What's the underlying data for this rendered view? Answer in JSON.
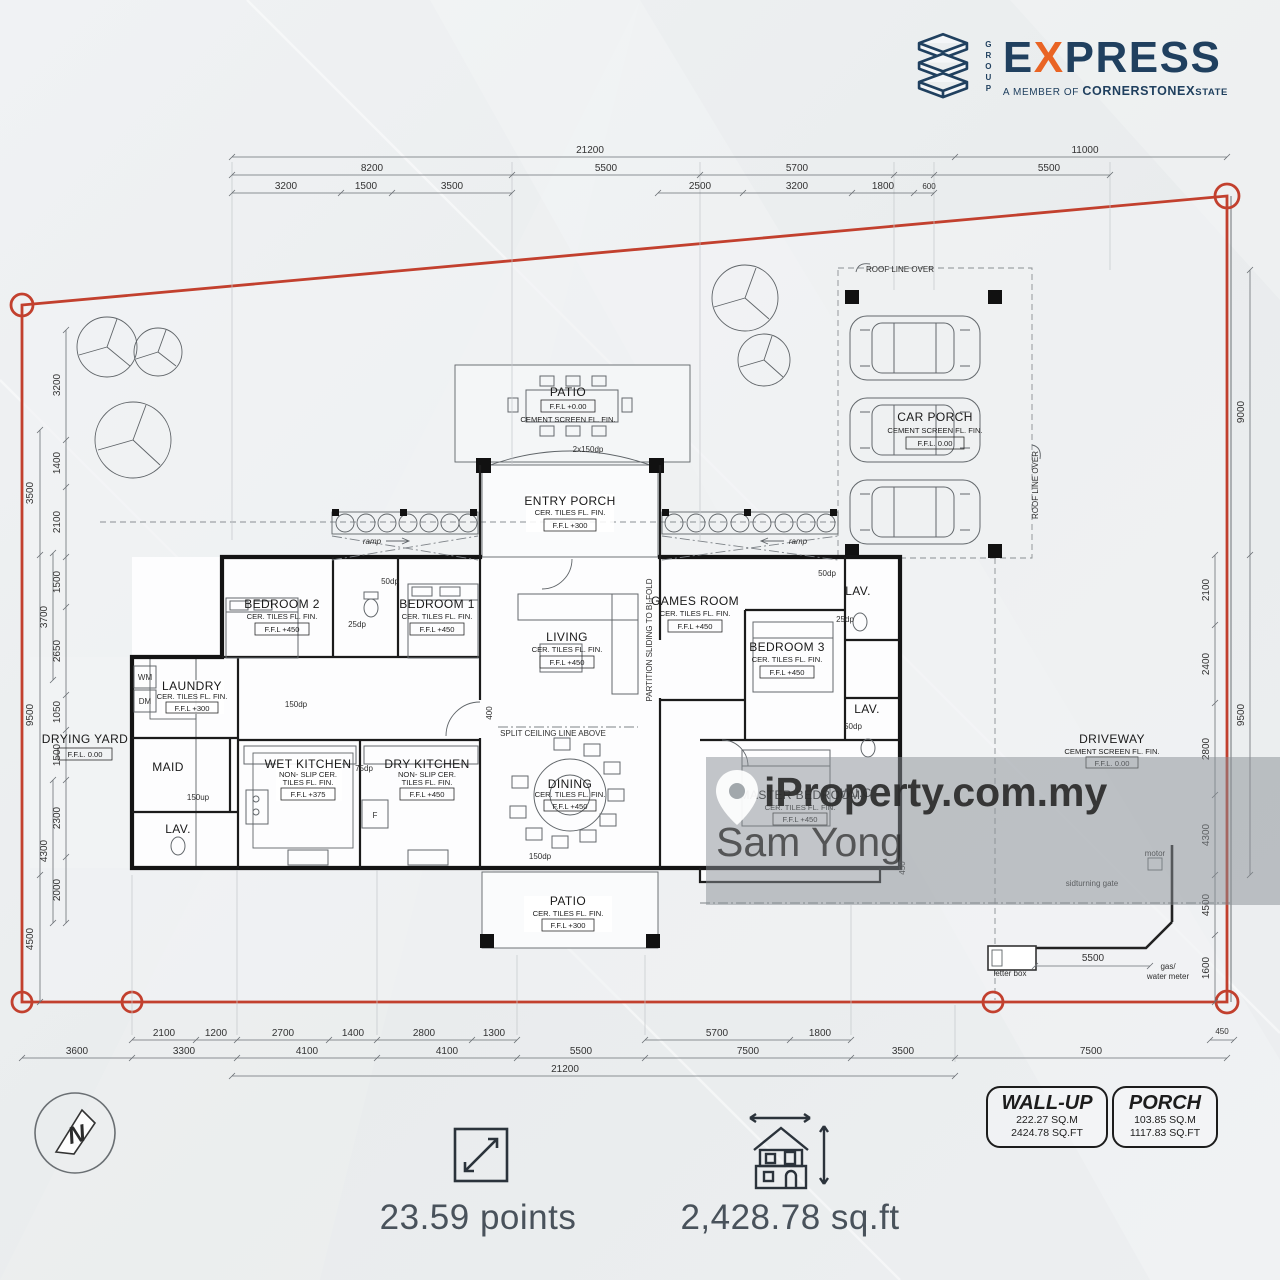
{
  "logo": {
    "group": "GROUP",
    "e": "E",
    "x": "X",
    "press": "PRESS",
    "member": "A MEMBER OF",
    "cornerstone": "CORNERSTONE",
    "x2": "X",
    "state": "STATE",
    "navy": "#20405f",
    "orange": "#e96424"
  },
  "watermark": {
    "brand": "iProperty.com.my",
    "agent": "Sam Yong"
  },
  "compass": {
    "n": "N"
  },
  "footer": {
    "points": "23.59 points",
    "area": "2,428.78 sq.ft"
  },
  "boxes": {
    "wall_up": {
      "title": "WALL-UP",
      "sqm": "222.27  SQ.M",
      "sqft": "2424.78  SQ.FT"
    },
    "porch": {
      "title": "PORCH",
      "sqm": "103.85  SQ.M",
      "sqft": "1117.83  SQ.FT"
    }
  },
  "rooms": {
    "patio_top": {
      "name": "PATIO",
      "ffl": "F.F.L +0.00",
      "l1": "CEMENT SCREEN FL. FIN."
    },
    "entry_porch": {
      "name": "ENTRY PORCH",
      "l1": "CER. TILES FL. FIN.",
      "ffl": "F.F.L +300"
    },
    "car_porch": {
      "name": "CAR PORCH",
      "l1": "CEMENT SCREEN FL. FIN.",
      "ffl": "F.F.L. 0.00"
    },
    "bedroom2": {
      "name": "BEDROOM 2",
      "l1": "CER. TILES FL. FIN.",
      "ffl": "F.F.L +450"
    },
    "bedroom1": {
      "name": "BEDROOM 1",
      "l1": "CER. TILES FL. FIN.",
      "ffl": "F.F.L +450"
    },
    "living": {
      "name": "LIVING",
      "l1": "CER. TILES FL. FIN.",
      "ffl": "F.F.L +450"
    },
    "games": {
      "name": "GAMES ROOM",
      "l1": "CER. TILES FL. FIN.",
      "ffl": "F.F.L +450"
    },
    "bedroom3": {
      "name": "BEDROOM 3",
      "l1": "CER. TILES FL. FIN.",
      "ffl": "F.F.L +450"
    },
    "laundry": {
      "name": "LAUNDRY",
      "l1": "CER. TILES FL. FIN.",
      "ffl": "F.F.L +300"
    },
    "drying": {
      "name": "DRYING YARD",
      "ffl": "F.F.L. 0.00"
    },
    "maid": {
      "name": "MAID"
    },
    "lav": {
      "name": "LAV."
    },
    "wet_kitchen": {
      "name": "WET KITCHEN",
      "l1": "NON- SLIP CER.",
      "l2": "TILES FL. FIN.",
      "ffl": "F.F.L +375"
    },
    "dry_kitchen": {
      "name": "DRY KITCHEN",
      "l1": "NON- SLIP CER.",
      "l2": "TILES FL. FIN.",
      "ffl": "F.F.L +450"
    },
    "dining": {
      "name": "DINING",
      "l1": "CER. TILES FL. FIN.",
      "ffl": "F.F.L +450"
    },
    "master": {
      "name": "MASTER BEDROOM",
      "l1": "CER. TILES FL. FIN.",
      "ffl": "F.F.L +450"
    },
    "wic": {
      "name": "W.I.C"
    },
    "patio_bottom": {
      "name": "PATIO",
      "l1": "CER. TILES FL. FIN.",
      "ffl": "F.F.L +300"
    },
    "driveway": {
      "name": "DRIVEWAY",
      "l1": "CEMENT SCREEN FL. FIN.",
      "ffl": "F.F.L. 0.00"
    }
  },
  "ann": {
    "roof_line": "ROOF LINE OVER",
    "split": "SPLIT CEILING LINE ABOVE",
    "partition": "PARTITION SLIDING TO BI-FOLD",
    "ramp": "ramp",
    "gate": "sidturning gate",
    "letterbox": "letter box",
    "gas": "gas/",
    "water": "water meter",
    "motor": "motor",
    "wm": "WM",
    "dm": "DM",
    "fridge": "F"
  },
  "dims": {
    "top1": [
      "21200",
      "11000"
    ],
    "top2": [
      "8200",
      "5500",
      "5700",
      "5500"
    ],
    "top3": [
      "3200",
      "1500",
      "3500",
      "2500",
      "3200",
      "1800",
      "600"
    ],
    "bot1": [
      "2100",
      "1200",
      "2700",
      "1400",
      "2800",
      "1300",
      "5700",
      "1800"
    ],
    "bot2": [
      "3600",
      "3300",
      "4100",
      "4100",
      "5500",
      "7500",
      "3500",
      "7500"
    ],
    "bot3": [
      "21200"
    ],
    "b450": "450",
    "left_outer": [
      "3500",
      "9500",
      "4500"
    ],
    "left_mid": [
      "3700",
      "4300"
    ],
    "left_inner": [
      "3200",
      "1400",
      "2100",
      "1500",
      "2650",
      "1050",
      "1500",
      "2300",
      "2000"
    ],
    "right_outer": [
      "9000",
      "9500"
    ],
    "right_inner": [
      "2100",
      "2400",
      "2800",
      "4300",
      "4500",
      "1600"
    ],
    "gate": "5500",
    "small": [
      "50dp",
      "25dp",
      "150dp",
      "75dp",
      "400",
      "2x150dp",
      "150up",
      "50dp",
      "25dp",
      "150dp",
      "450",
      "50dp"
    ]
  },
  "colors": {
    "boundary": "#c2402e",
    "band": "#878e93"
  }
}
